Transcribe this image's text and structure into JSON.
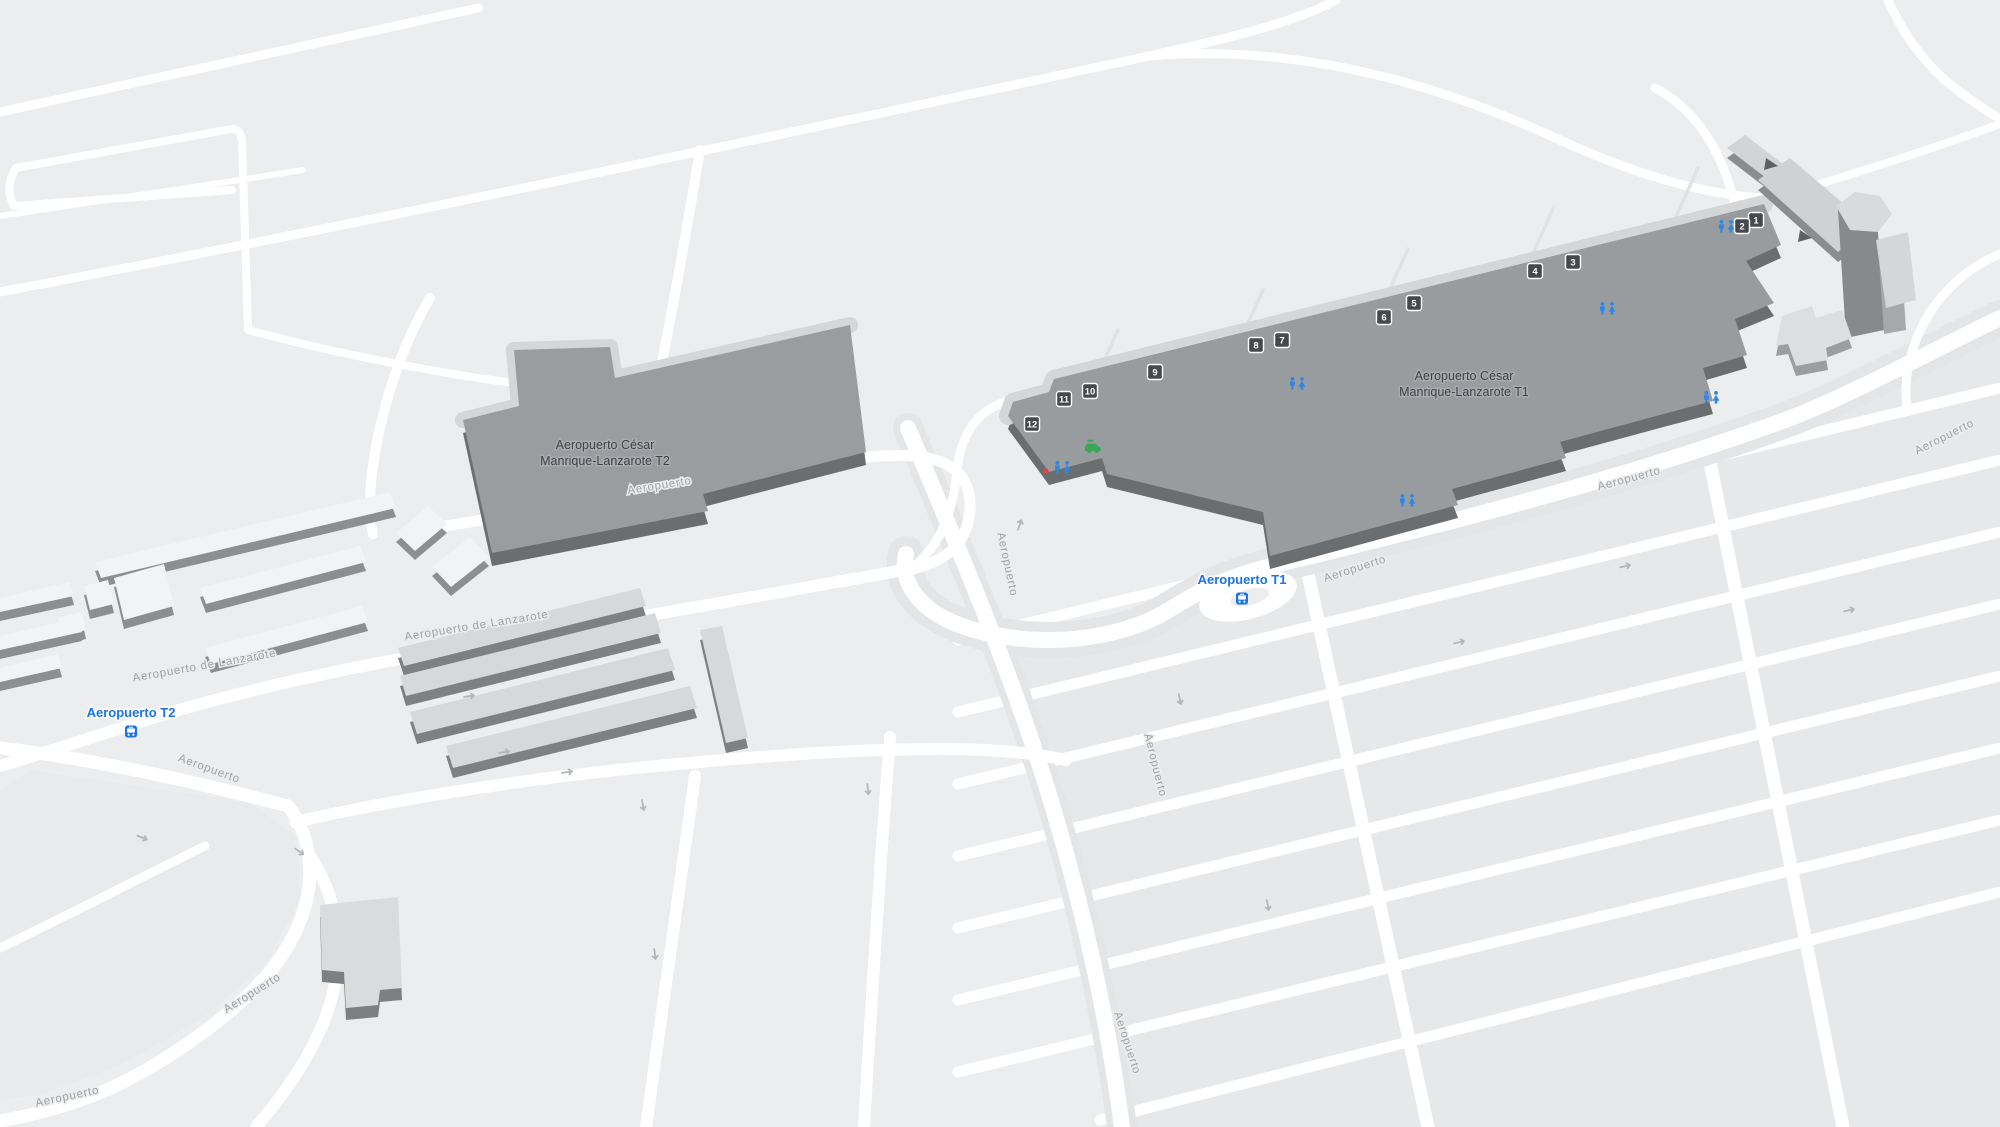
{
  "map": {
    "title": "Aeropuerto César Manrique-Lanzarote",
    "terminals": [
      {
        "id": "t2",
        "lines": [
          "Aeropuerto César",
          "Manrique-Lanzarote T2"
        ],
        "x": 605,
        "y": 449
      },
      {
        "id": "t1",
        "lines": [
          "Aeropuerto César",
          "Manrique-Lanzarote T1"
        ],
        "x": 1464,
        "y": 380
      }
    ],
    "gates": [
      {
        "label": "1",
        "x": 1756,
        "y": 220
      },
      {
        "label": "2",
        "x": 1742,
        "y": 226
      },
      {
        "label": "3",
        "x": 1573,
        "y": 262
      },
      {
        "label": "4",
        "x": 1535,
        "y": 271
      },
      {
        "label": "5",
        "x": 1414,
        "y": 303
      },
      {
        "label": "6",
        "x": 1384,
        "y": 317
      },
      {
        "label": "7",
        "x": 1282,
        "y": 340
      },
      {
        "label": "8",
        "x": 1256,
        "y": 345
      },
      {
        "label": "9",
        "x": 1155,
        "y": 372
      },
      {
        "label": "10",
        "x": 1090,
        "y": 391
      },
      {
        "label": "11",
        "x": 1064,
        "y": 399
      },
      {
        "label": "12",
        "x": 1032,
        "y": 424
      }
    ],
    "restrooms": [
      {
        "x": 1727,
        "y": 227
      },
      {
        "x": 1608,
        "y": 309
      },
      {
        "x": 1712,
        "y": 398
      },
      {
        "x": 1298,
        "y": 384
      },
      {
        "x": 1408,
        "y": 501
      },
      {
        "x": 1063,
        "y": 468
      }
    ],
    "services": {
      "car_rental": {
        "x": 1093,
        "y": 447
      },
      "poi_marker": {
        "x": 1046,
        "y": 471
      }
    },
    "bus_stops": [
      {
        "label": "Aeropuerto T2",
        "x": 131,
        "y": 717
      },
      {
        "label": "Aeropuerto T1",
        "x": 1242,
        "y": 584
      }
    ],
    "road_labels": [
      {
        "text": "Aeropuerto",
        "x": 660,
        "y": 489,
        "rot": -9
      },
      {
        "text": "Aeropuerto",
        "x": 1356,
        "y": 572,
        "rot": -18
      },
      {
        "text": "Aeropuerto",
        "x": 1630,
        "y": 482,
        "rot": -15
      },
      {
        "text": "Aeropuerto",
        "x": 1946,
        "y": 440,
        "rot": -27
      },
      {
        "text": "Aeropuerto de Lanzarote",
        "x": 205,
        "y": 669,
        "rot": -10
      },
      {
        "text": "Aeropuerto de Lanzarote",
        "x": 477,
        "y": 629,
        "rot": -9
      },
      {
        "text": "Aeropuerto",
        "x": 208,
        "y": 772,
        "rot": 20
      },
      {
        "text": "Aeropuerto",
        "x": 254,
        "y": 996,
        "rot": -32
      },
      {
        "text": "Aeropuerto",
        "x": 68,
        "y": 1100,
        "rot": -12
      },
      {
        "text": "Aeropuerto",
        "x": 1004,
        "y": 565,
        "rot": 78
      },
      {
        "text": "Aeropuerto",
        "x": 1152,
        "y": 766,
        "rot": 76
      },
      {
        "text": "Aeropuerto",
        "x": 1124,
        "y": 1044,
        "rot": 72
      }
    ],
    "colors": {
      "background": "#ecedee",
      "road": "#ffffff",
      "road_shoulder": "#e3e5e6",
      "parking_block": "#e6e8e9",
      "terminal_roof": "#999c9f",
      "terminal_wall": "#6b6e71",
      "apron_band": "#d4d6d8",
      "building_light": "#f2f3f4",
      "building_side": "#8c8f92",
      "hangar_top": "#d6d8d9",
      "hangar_side": "#7e8184",
      "badge": "#45484c",
      "restroom_blue": "#2f86e3",
      "bus_blue": "#1a73e8",
      "car_green": "#3aa757",
      "marker_red": "#e8453c",
      "label_gray": "#9da1a5",
      "terminal_label": "#3f4347"
    }
  }
}
